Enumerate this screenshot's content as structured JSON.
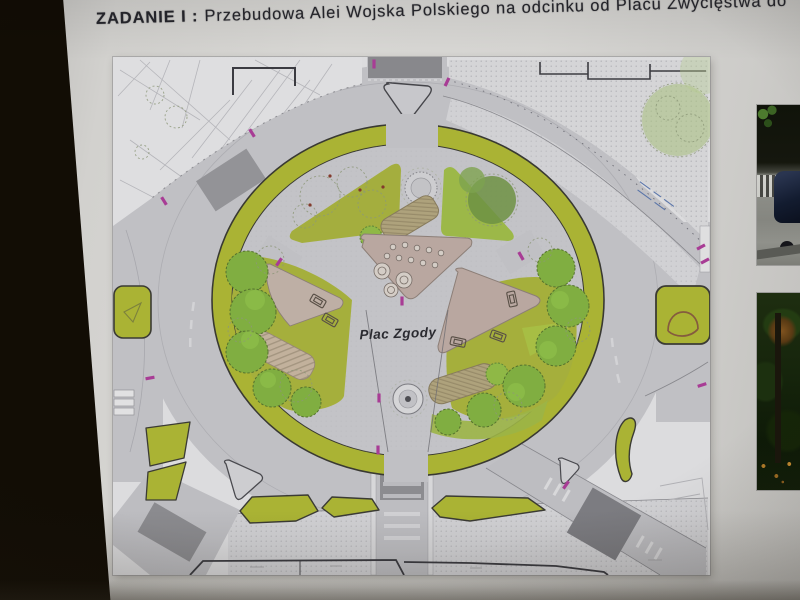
{
  "frame": {
    "backdrop_color": "#16110a"
  },
  "slide": {
    "title": {
      "prefix": "ZADANIE I :",
      "text": "Przebudowa Alei Wojska Polskiego na odcinku od Placu Zwycięstwa do"
    }
  },
  "plan": {
    "center_label": "Plac Zgody",
    "colors": {
      "paper": "#dfdfe2",
      "road": "#c3c3c7",
      "sidewalk": "#d6d6d9",
      "crosswalk_dark": "#8a8a8e",
      "greenway_olive": "#adb72b",
      "grass": "#a8b334",
      "tree_green": "#7fb23a",
      "gravel_tan": "#bda9a1",
      "deck_tan": "#b2a47b",
      "crossing_marker_magenta": "#b23a9c",
      "annotation_blue": "#4e6fae",
      "outline": "#3c3c42"
    }
  },
  "photos": {
    "top": {
      "name": "street-scene-photo"
    },
    "bottom": {
      "name": "park-greenery-photo"
    }
  }
}
